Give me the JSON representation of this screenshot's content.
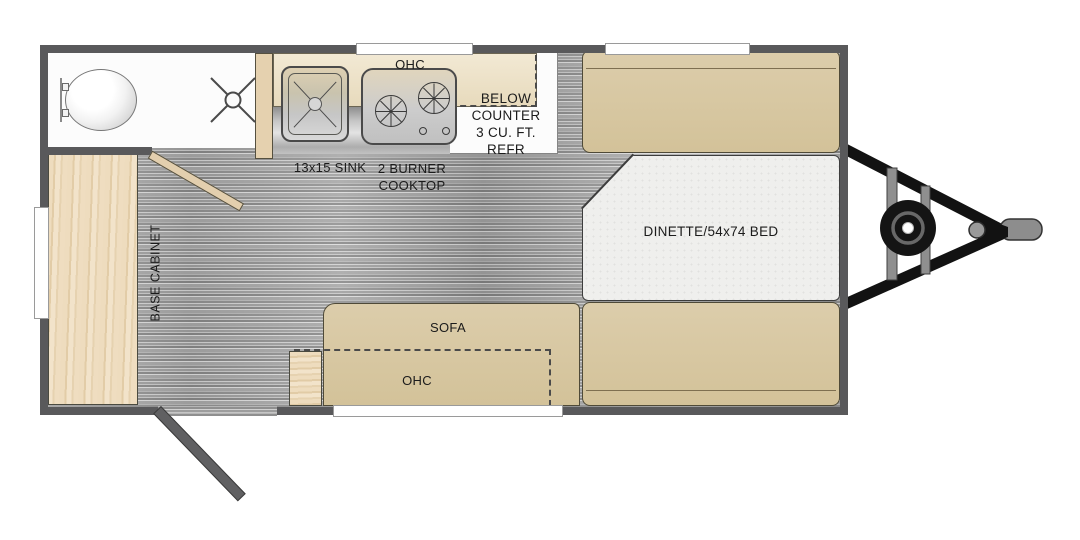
{
  "diagram_title": "Travel trailer floor plan",
  "labels": {
    "kitchen_ohc": "OHC",
    "below_counter_lines": [
      "BELOW",
      "COUNTER",
      "3 CU. FT.",
      "REFR"
    ],
    "sink": "13x15 SINK",
    "cooktop_lines": [
      "2 BURNER",
      "COOKTOP"
    ],
    "dinette": "DINETTE/54x74 BED",
    "sofa": "SOFA",
    "sofa_ohc": "OHC",
    "base_cabinet": "BASE CABINET"
  },
  "colors": {
    "wall": "#59595b",
    "furniture_tan": "#d7c7a0",
    "cabinet_wood": "#ecd9ba",
    "overhead_cabinet": "#ecdfc4",
    "floor_gray": "#a9a9a9",
    "table_top": "#efefed",
    "stainless": "#c6c6c6",
    "hitch_black": "#121212",
    "hitch_gray": "#8d8d8d",
    "door_wood": "#e3cfae",
    "entry_door": "#606062",
    "label": "#1b1b1b"
  }
}
